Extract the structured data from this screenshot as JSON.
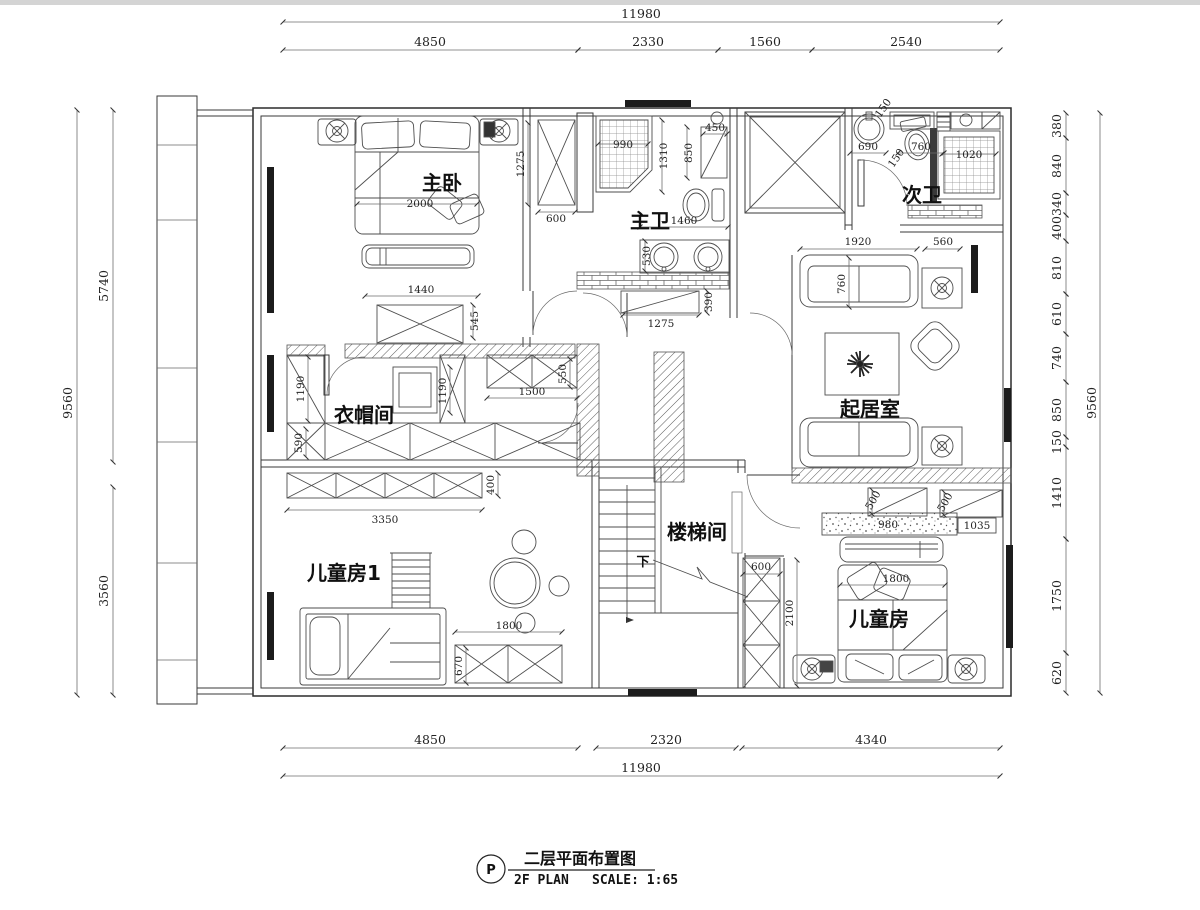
{
  "title": {
    "mark": "P",
    "cn": "二层平面布置图",
    "en": "2F PLAN",
    "scale": "SCALE: 1:65"
  },
  "rooms": {
    "master_bedroom": "主卧",
    "master_bath": "主卫",
    "secondary_bath": "次卫",
    "cloakroom": "衣帽间",
    "living_room": "起居室",
    "stairwell": "楼梯间",
    "kids_room_1": "儿童房1",
    "kids_room": "儿童房",
    "stairs_down": "下"
  },
  "dims": {
    "top_total": "11980",
    "top_segments": [
      "4850",
      "2330",
      "1560",
      "2540"
    ],
    "bottom_segments": [
      "4850",
      "2320",
      "4340"
    ],
    "bottom_total": "11980",
    "left_total": "9560",
    "left_segments": [
      "5740",
      "3560"
    ],
    "right_total": "9560",
    "right_segments": [
      "380",
      "840",
      "340",
      "400",
      "810",
      "610",
      "740",
      "850",
      "150",
      "1410",
      "1750",
      "620"
    ]
  },
  "dim_labels": [
    {
      "t": "11980",
      "x": 641,
      "y": 18,
      "r": 0,
      "big": 1
    },
    {
      "t": "4850",
      "x": 430,
      "y": 46,
      "r": 0,
      "big": 1
    },
    {
      "t": "2330",
      "x": 648,
      "y": 46,
      "r": 0,
      "big": 1
    },
    {
      "t": "1560",
      "x": 765,
      "y": 46,
      "r": 0,
      "big": 1
    },
    {
      "t": "2540",
      "x": 906,
      "y": 46,
      "r": 0,
      "big": 1
    },
    {
      "t": "4850",
      "x": 430,
      "y": 744,
      "r": 0,
      "big": 1
    },
    {
      "t": "2320",
      "x": 666,
      "y": 744,
      "r": 0,
      "big": 1
    },
    {
      "t": "4340",
      "x": 871,
      "y": 744,
      "r": 0,
      "big": 1
    },
    {
      "t": "11980",
      "x": 641,
      "y": 772,
      "r": 0,
      "big": 1
    },
    {
      "t": "9560",
      "x": 72,
      "y": 403,
      "r": -90,
      "big": 1
    },
    {
      "t": "5740",
      "x": 108,
      "y": 286,
      "r": -90,
      "big": 1
    },
    {
      "t": "3560",
      "x": 108,
      "y": 591,
      "r": -90,
      "big": 1
    },
    {
      "t": "9560",
      "x": 1096,
      "y": 403,
      "r": -90,
      "big": 1
    },
    {
      "t": "380",
      "x": 1061,
      "y": 126,
      "r": -90,
      "big": 1
    },
    {
      "t": "840",
      "x": 1061,
      "y": 166,
      "r": -90,
      "big": 1
    },
    {
      "t": "340",
      "x": 1061,
      "y": 204,
      "r": -90,
      "big": 1
    },
    {
      "t": "400",
      "x": 1061,
      "y": 228,
      "r": -90,
      "big": 1
    },
    {
      "t": "810",
      "x": 1061,
      "y": 268,
      "r": -90,
      "big": 1
    },
    {
      "t": "610",
      "x": 1061,
      "y": 314,
      "r": -90,
      "big": 1
    },
    {
      "t": "740",
      "x": 1061,
      "y": 358,
      "r": -90,
      "big": 1
    },
    {
      "t": "850",
      "x": 1061,
      "y": 410,
      "r": -90,
      "big": 1
    },
    {
      "t": "150",
      "x": 1061,
      "y": 442,
      "r": -90,
      "big": 1
    },
    {
      "t": "1410",
      "x": 1061,
      "y": 493,
      "r": -90,
      "big": 1
    },
    {
      "t": "1750",
      "x": 1061,
      "y": 596,
      "r": -90,
      "big": 1
    },
    {
      "t": "620",
      "x": 1061,
      "y": 673,
      "r": -90,
      "big": 1
    },
    {
      "t": "2000",
      "x": 420,
      "y": 207,
      "r": 0
    },
    {
      "t": "1440",
      "x": 421,
      "y": 293,
      "r": 0
    },
    {
      "t": "545",
      "x": 478,
      "y": 321,
      "r": -90
    },
    {
      "t": "1275",
      "x": 524,
      "y": 164,
      "r": -90
    },
    {
      "t": "600",
      "x": 556,
      "y": 222,
      "r": 0
    },
    {
      "t": "990",
      "x": 623,
      "y": 148,
      "r": 0
    },
    {
      "t": "1310",
      "x": 667,
      "y": 156,
      "r": -90
    },
    {
      "t": "850",
      "x": 692,
      "y": 153,
      "r": -90
    },
    {
      "t": "450",
      "x": 715,
      "y": 131,
      "r": 0
    },
    {
      "t": "1460",
      "x": 684,
      "y": 224,
      "r": 0
    },
    {
      "t": "530",
      "x": 650,
      "y": 256,
      "r": -90
    },
    {
      "t": "390",
      "x": 712,
      "y": 302,
      "r": -90
    },
    {
      "t": "1275",
      "x": 661,
      "y": 327,
      "r": 0
    },
    {
      "t": "690",
      "x": 868,
      "y": 150,
      "r": 0
    },
    {
      "t": "150",
      "x": 886,
      "y": 110,
      "r": -55
    },
    {
      "t": "150",
      "x": 899,
      "y": 160,
      "r": -55
    },
    {
      "t": "760",
      "x": 921,
      "y": 150,
      "r": 0
    },
    {
      "t": "1020",
      "x": 969,
      "y": 158,
      "r": 0
    },
    {
      "t": "1920",
      "x": 858,
      "y": 245,
      "r": 0
    },
    {
      "t": "560",
      "x": 943,
      "y": 245,
      "r": 0
    },
    {
      "t": "760",
      "x": 845,
      "y": 284,
      "r": -90
    },
    {
      "t": "1190",
      "x": 304,
      "y": 389,
      "r": -90
    },
    {
      "t": "1190",
      "x": 446,
      "y": 391,
      "r": -90
    },
    {
      "t": "550",
      "x": 566,
      "y": 374,
      "r": -90
    },
    {
      "t": "1500",
      "x": 532,
      "y": 395,
      "r": 0
    },
    {
      "t": "590",
      "x": 302,
      "y": 443,
      "r": -90
    },
    {
      "t": "3350",
      "x": 385,
      "y": 523,
      "r": 0
    },
    {
      "t": "400",
      "x": 494,
      "y": 485,
      "r": -90
    },
    {
      "t": "600",
      "x": 761,
      "y": 570,
      "r": 0
    },
    {
      "t": "2100",
      "x": 793,
      "y": 613,
      "r": -90
    },
    {
      "t": "500",
      "x": 876,
      "y": 502,
      "r": -60
    },
    {
      "t": "500",
      "x": 948,
      "y": 504,
      "r": -60
    },
    {
      "t": "980",
      "x": 888,
      "y": 528,
      "r": 0
    },
    {
      "t": "1035",
      "x": 977,
      "y": 529,
      "r": 0
    },
    {
      "t": "1800",
      "x": 896,
      "y": 582,
      "r": 0
    },
    {
      "t": "1800",
      "x": 509,
      "y": 629,
      "r": 0
    },
    {
      "t": "670",
      "x": 462,
      "y": 666,
      "r": -90
    }
  ]
}
